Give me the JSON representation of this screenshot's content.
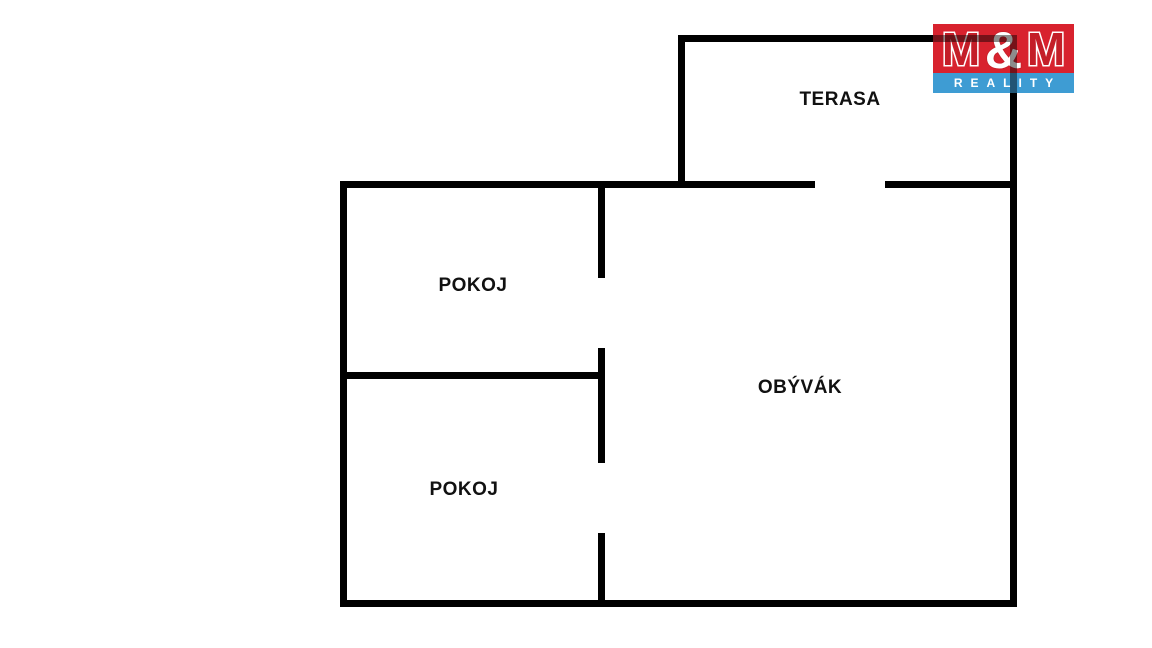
{
  "page": {
    "background_color": "#ffffff",
    "wall_color": "#000000",
    "label_color": "#111111"
  },
  "floor_plan": {
    "rooms": [
      {
        "id": "terasa",
        "label": "TERASA"
      },
      {
        "id": "pokoj-top",
        "label": "POKOJ"
      },
      {
        "id": "obyvak",
        "label": "OBÝVÁK"
      },
      {
        "id": "pokoj-bottom",
        "label": "POKOJ"
      }
    ]
  },
  "logo": {
    "m1": "M",
    "ampersand": "&",
    "m2": "M",
    "reality_label": "REALITY",
    "red_color": "#D8222E",
    "blue_color": "#3E9CD3",
    "text_color": "#FFFFFF"
  }
}
